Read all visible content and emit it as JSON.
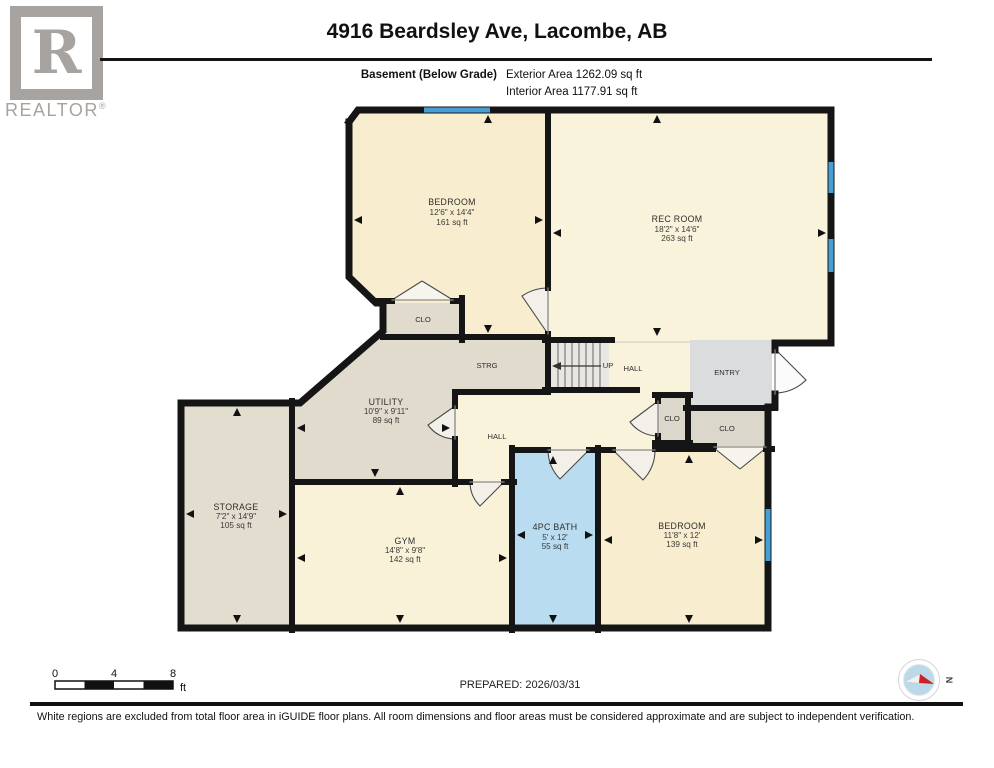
{
  "header": {
    "logo": {
      "letter": "R",
      "brand": "REALTOR",
      "reg": "®"
    },
    "title": "4916 Beardsley Ave, Lacombe, AB",
    "floor_label": "Basement (Below Grade)",
    "exterior_area": "Exterior Area 1262.09 sq ft",
    "interior_area": "Interior Area 1177.91 sq ft"
  },
  "plan": {
    "rooms": {
      "bedroom_tl": {
        "name": "BEDROOM",
        "dims": "12'6\" x 14'4\"",
        "area": "161 sq ft"
      },
      "rec_room": {
        "name": "REC ROOM",
        "dims": "18'2\" x 14'6\"",
        "area": "263 sq ft"
      },
      "clo_bedroom_tl": {
        "name": "CLO"
      },
      "strg": {
        "name": "STRG"
      },
      "stairs": {
        "name": "UP"
      },
      "hall_upper": {
        "name": "HALL"
      },
      "utility": {
        "name": "UTILITY",
        "dims": "10'9\" x 9'11\"",
        "area": "89 sq ft"
      },
      "hall_lower": {
        "name": "HALL"
      },
      "entry": {
        "name": "ENTRY"
      },
      "clo_hall": {
        "name": "CLO"
      },
      "clo_bedroom_br": {
        "name": "CLO"
      },
      "storage": {
        "name": "STORAGE",
        "dims": "7'2\" x 14'9\"",
        "area": "105 sq ft"
      },
      "gym": {
        "name": "GYM",
        "dims": "14'8\" x 9'8\"",
        "area": "142 sq ft"
      },
      "bath": {
        "name": "4PC BATH",
        "dims": "5' x 12'",
        "area": "55 sq ft"
      },
      "bedroom_br": {
        "name": "BEDROOM",
        "dims": "11'8\" x 12'",
        "area": "139 sq ft"
      }
    },
    "colors": {
      "room_cream": "#f8eecf",
      "room_cream_light": "#faf3dc",
      "room_tan": "#e1dbce",
      "room_gray": "#dadcdd",
      "room_closet": "#dcd7cb",
      "bath_blue": "#b9dcf1",
      "window_blue": "#459fd4",
      "wall": "#151515"
    }
  },
  "footer": {
    "scale": {
      "labels": [
        "0",
        "4",
        "8"
      ],
      "unit": "ft"
    },
    "prepared": "PREPARED: 2026/03/31",
    "compass_n": "N",
    "disclaimer": "White regions are excluded from total floor area in iGUIDE floor plans. All room dimensions and floor areas must be considered approximate and are subject to independent verification."
  }
}
